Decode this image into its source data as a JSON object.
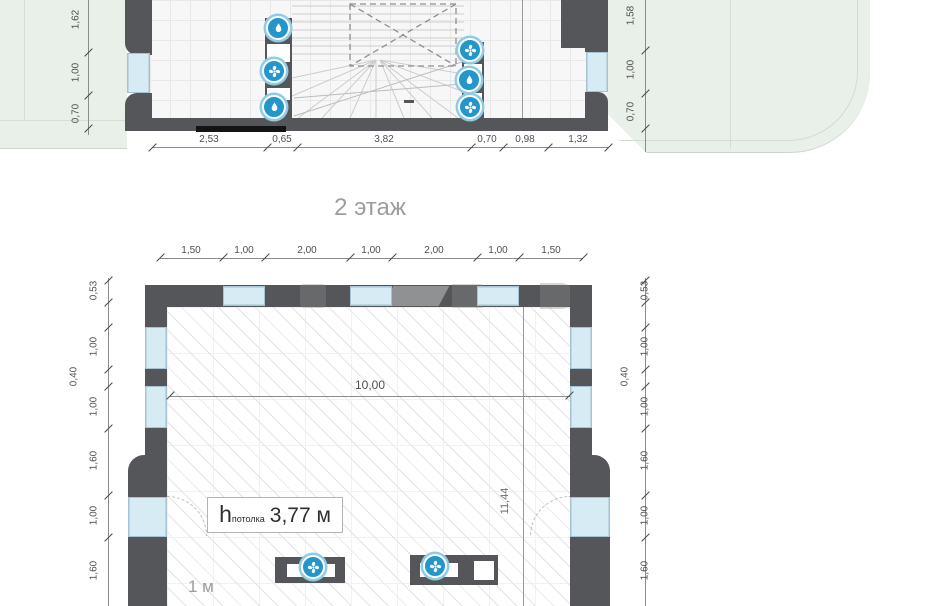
{
  "page": {
    "background": "#ffffff"
  },
  "floor_title": "2 этаж",
  "colors": {
    "wall": "#54565a",
    "window": "#d7ebf5",
    "roof_terrace_green": "#e9efe9",
    "icon_blue": "#2396cc",
    "dim_text": "#4f4f4f",
    "title_text": "#9d9d9d"
  },
  "icons": {
    "fan-icon": "blue circular badge with white pinwheel fan",
    "water-drop-icon": "blue circular badge with white water drop"
  },
  "upper_plan": {
    "left_dims": [
      "1,62",
      "1,00",
      "0,70"
    ],
    "right_dims": [
      "1,58",
      "1,00",
      "0,70"
    ],
    "bottom_dims": [
      "2,53",
      "0,65",
      "3,82",
      "0,70",
      "0,98",
      "1,32"
    ],
    "left_shaft_icons": [
      "water-drop-icon",
      "fan-icon",
      "water-drop-icon"
    ],
    "right_shaft_icons": [
      "fan-icon",
      "water-drop-icon",
      "fan-icon"
    ]
  },
  "lower_plan": {
    "top_dims": [
      "1,50",
      "1,00",
      "2,00",
      "1,00",
      "2,00",
      "1,00",
      "1,50"
    ],
    "left_dims": [
      "0,53",
      "1,00",
      "0,40",
      "1,00",
      "1,60",
      "1,00",
      "1,60"
    ],
    "right_dims": [
      "0,53",
      "1,00",
      "0,40",
      "1,00",
      "1,60",
      "1,00",
      "1,60"
    ],
    "room_width": "10,00",
    "room_depth": "11,44",
    "ceiling_height": {
      "symbol": "h",
      "subscript": "потолка",
      "value": "3,77 м"
    },
    "scale_note": "1 м",
    "floor_unit_icons": [
      "fan-icon",
      "fan-icon"
    ]
  }
}
